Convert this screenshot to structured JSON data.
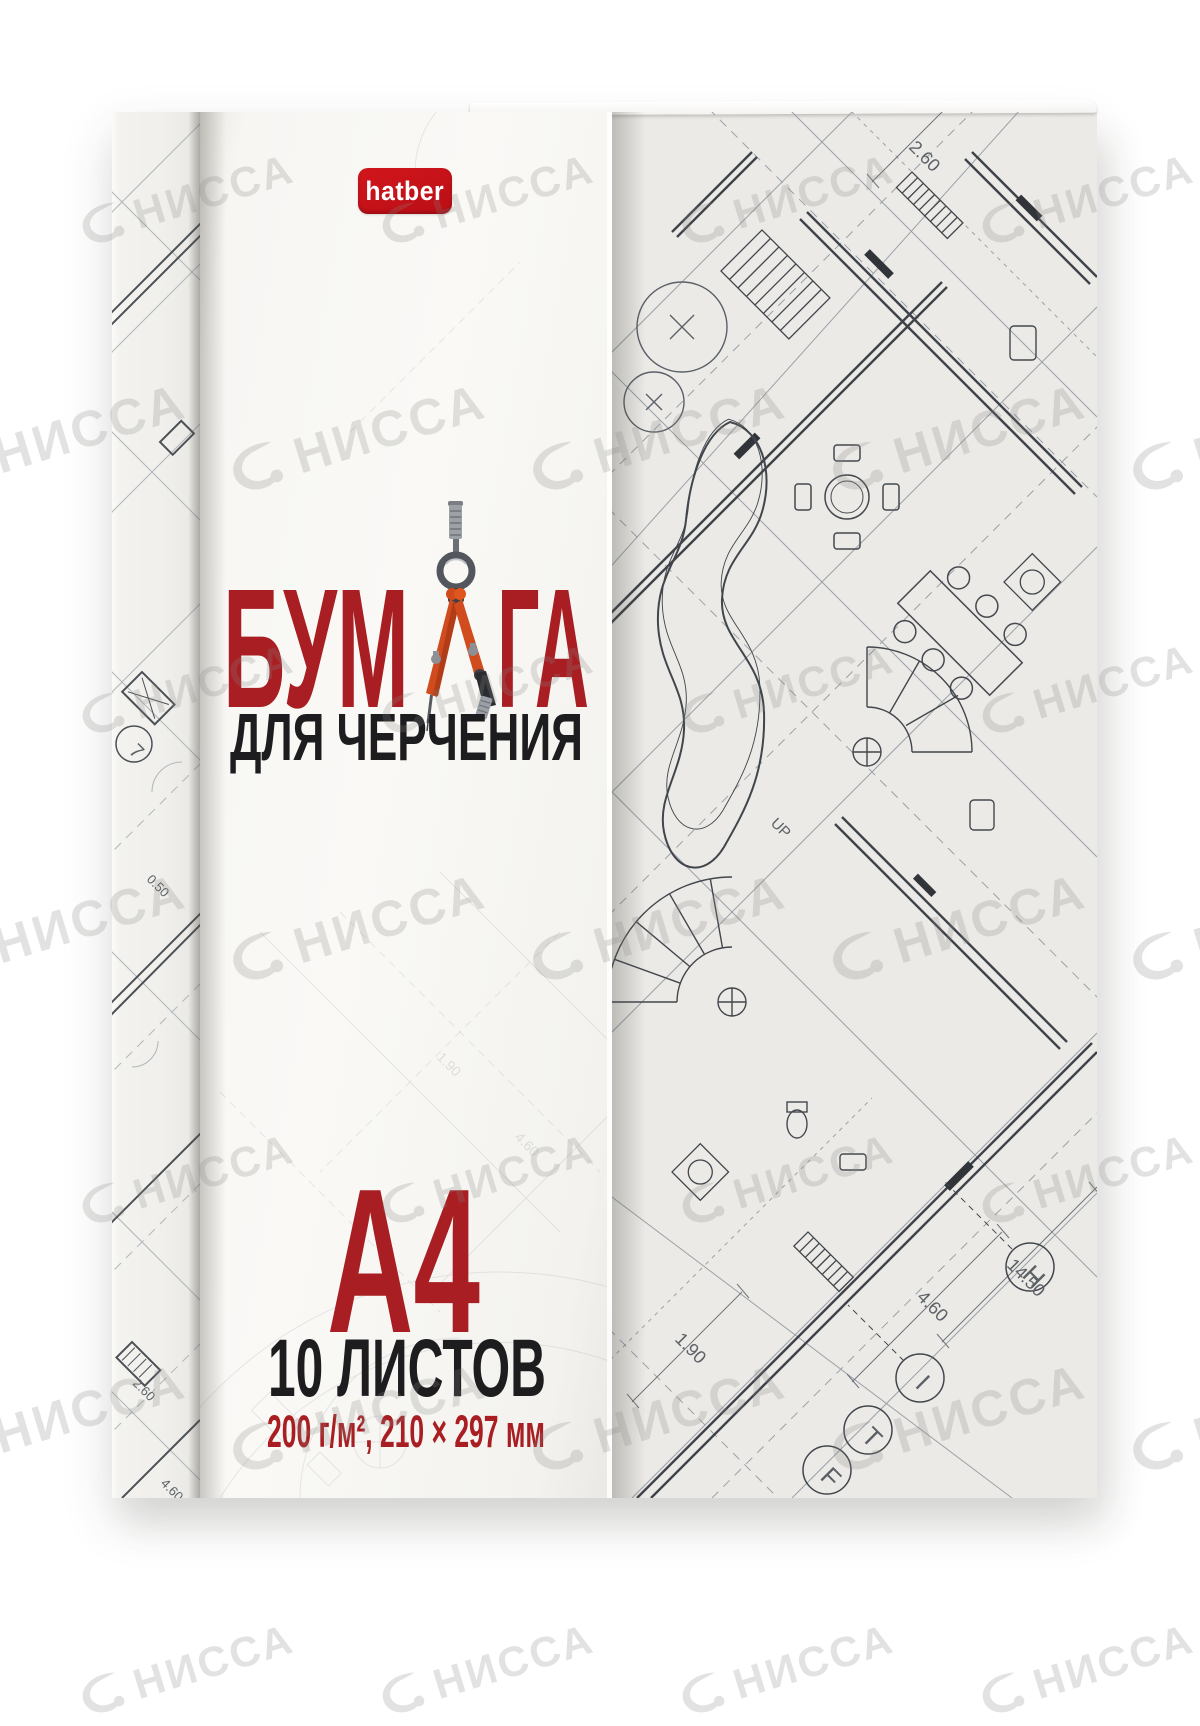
{
  "product": {
    "brand": "hatber",
    "title_prefix": "БУМ",
    "title_suffix": "ГА",
    "subtitle": "ДЛЯ ЧЕРЧЕНИЯ",
    "format": "А4",
    "sheets_count": "10 ЛИСТОВ",
    "specs": "200 г/м², 210 × 297 мм"
  },
  "watermark": {
    "text": "НИССА"
  },
  "colors": {
    "title_red": "#a81e22",
    "logo_red": "#c6131b",
    "text_black": "#1d1d20",
    "blueprint_line": "#41464d",
    "paper": "#f7f6f2"
  },
  "blueprint": {
    "labels": {
      "up": "UP",
      "d1": "14.50",
      "d2": "4.60",
      "d3": "1.90",
      "d4": "2.60",
      "d5": "0.50",
      "d6": "4.60",
      "d7": "1.90",
      "d8": "4.60"
    },
    "markers": {
      "m1": "H",
      "m2": "I",
      "m3": "F",
      "m4": "Т",
      "m5": "7"
    }
  }
}
